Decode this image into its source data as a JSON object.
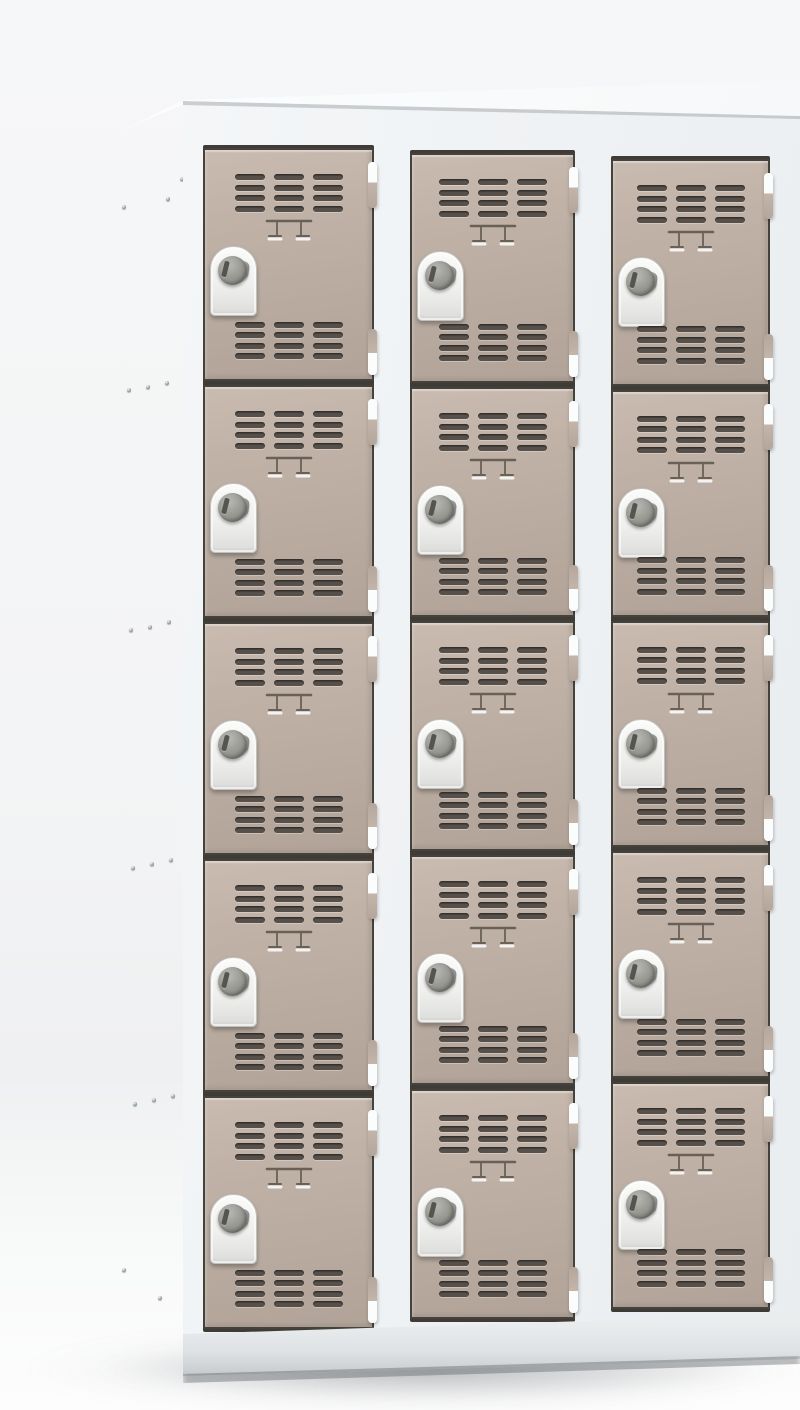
{
  "meta": {
    "scene_description": "studio product photo of a metal multi-compartment locker cabinet, three-quarter view from upper left",
    "visible_text": "",
    "compartments_total": 15
  },
  "palette": {
    "bg_top": "#f6f7f8",
    "bg_floor": "#fdfdfd",
    "top_surface": "#fcfdfe",
    "side_panel": "#d5d9da",
    "front_face": "#f4f6f8",
    "plinth_edge": "#ccd0d2",
    "gap_color": "#3f3c37",
    "door_color": "#c0b2a7",
    "door_light": "#c9bbb0",
    "door_dark": "#b1a398",
    "door_outline": "#45423c",
    "slat_color": "#57504a",
    "lock_plate": "#efefed",
    "lock_cylinder": "#96968f",
    "hinge_white": "#fbfcfc",
    "hinge_beige": "#b4a69a",
    "rivet": "#99a0a3"
  },
  "cabinet": {
    "rows": 5,
    "columns": 3,
    "face": {
      "left": 183,
      "top": 80,
      "width": 617,
      "height": 1300
    },
    "columns_layout": [
      {
        "left": 20,
        "top": 65,
        "width": 171,
        "height": 1187
      },
      {
        "left": 227,
        "top": 70,
        "width": 165,
        "height": 1172
      },
      {
        "left": 428,
        "top": 76,
        "width": 159,
        "height": 1156
      }
    ],
    "door_features": {
      "top_vent": {
        "top": 24,
        "groups": 3,
        "slats_per_group": 4
      },
      "bottom_vent": {
        "bottom": 20,
        "groups": 3,
        "slats_per_group": 4
      },
      "label_holder": {
        "top": 66,
        "width": 50,
        "height": 28
      },
      "lock": {
        "left": 5,
        "top": 96,
        "width": 45,
        "height": 68
      },
      "hinge_top": {
        "top": 12,
        "height": 46
      },
      "hinge_bottom": {
        "bottom": 4,
        "height": 46
      }
    }
  },
  "side_panel": {
    "rivets": [
      [
        68,
        79
      ],
      [
        10,
        107
      ],
      [
        54,
        99
      ],
      [
        15,
        290
      ],
      [
        34,
        287
      ],
      [
        53,
        283
      ],
      [
        17,
        530
      ],
      [
        36,
        527
      ],
      [
        55,
        522
      ],
      [
        19,
        768
      ],
      [
        38,
        764
      ],
      [
        57,
        760
      ],
      [
        21,
        1004
      ],
      [
        40,
        1000
      ],
      [
        59,
        996
      ],
      [
        10,
        1170
      ],
      [
        46,
        1198
      ]
    ]
  }
}
